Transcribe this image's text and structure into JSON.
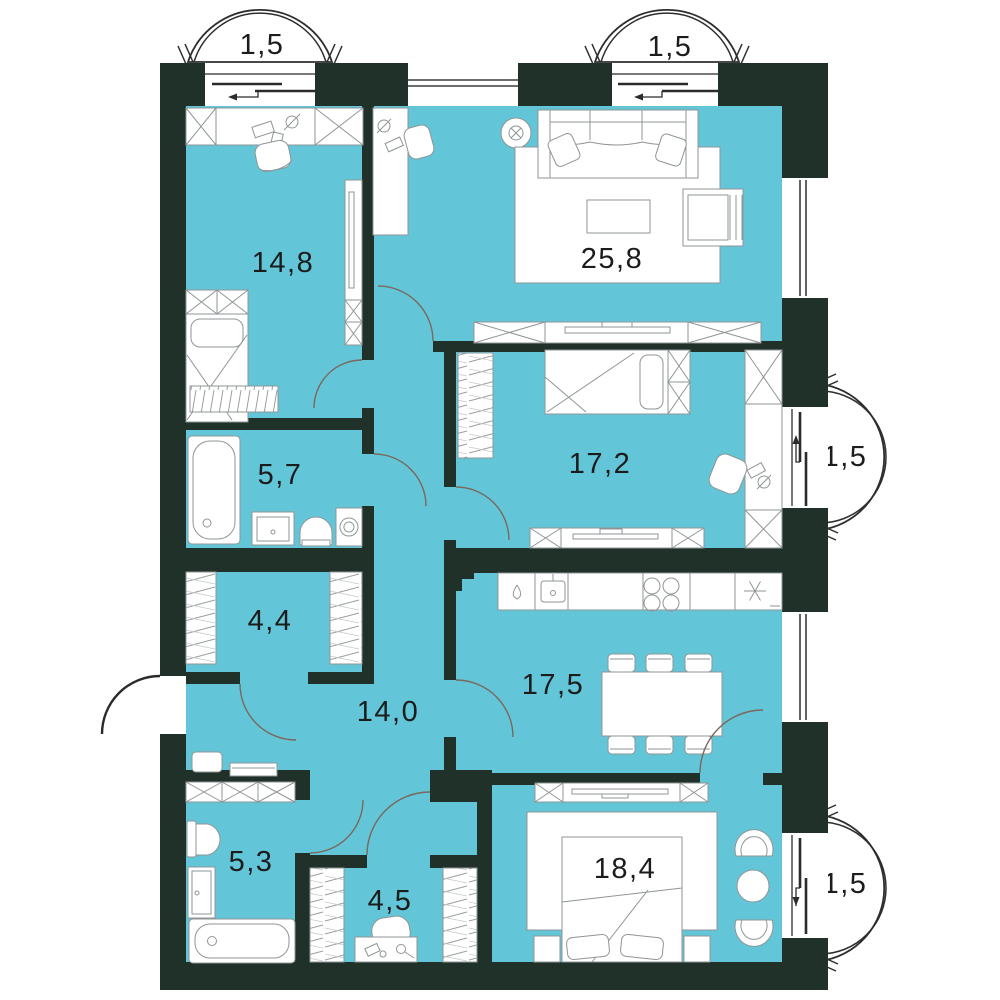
{
  "plan": {
    "colors": {
      "wall": "#20312a",
      "floor": "#63c5d8",
      "furniture-line": "#8f9596",
      "door-arc": "#7b685c",
      "window-line": "#3c3c3c",
      "label": "#1c1c1c"
    },
    "rooms": {
      "bedroom1": {
        "name": "bedroom-top-left",
        "area": "14,8"
      },
      "living": {
        "name": "living-room",
        "area": "25,8"
      },
      "bath1": {
        "name": "bathroom-top",
        "area": "5,7"
      },
      "bedroom2": {
        "name": "bedroom-middle",
        "area": "17,2"
      },
      "storage": {
        "name": "closet",
        "area": "4,4"
      },
      "hall": {
        "name": "hallway",
        "area": "14,0"
      },
      "kitchen": {
        "name": "kitchen-dining",
        "area": "17,5"
      },
      "bath2": {
        "name": "bathroom-bottom",
        "area": "5,3"
      },
      "dressing": {
        "name": "dressing-room",
        "area": "4,5"
      },
      "bedroom3": {
        "name": "bedroom-bottom-right",
        "area": "18,4"
      }
    },
    "balconies": {
      "topLeft": {
        "area": "1,5"
      },
      "topRight": {
        "area": "1,5"
      },
      "rightMiddle": {
        "area": "1,5"
      },
      "rightBottom": {
        "area": "1,5"
      }
    }
  }
}
